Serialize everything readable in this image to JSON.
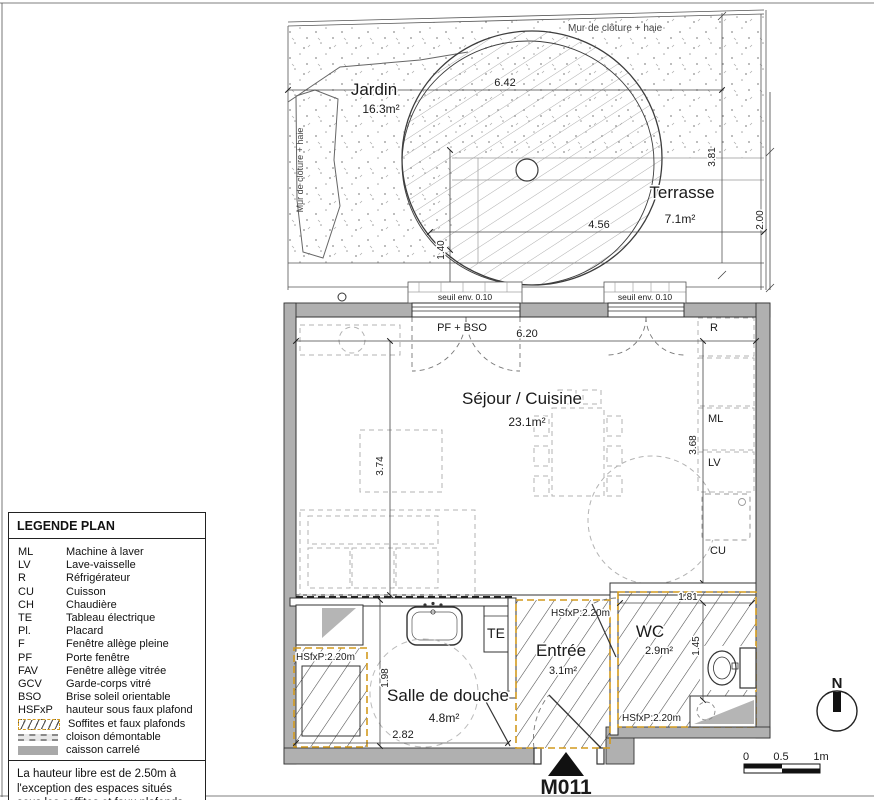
{
  "plan": {
    "labels": {
      "mur_top": "Mur de clôture + haie",
      "mur_left": "Mur de clôture + haie",
      "pf_bso": "PF + BSO",
      "seuil_left": "seuil env. 0.10",
      "seuil_right": "seuil env. 0.10",
      "te": "TE",
      "r": "R",
      "ml": "ML",
      "lv": "LV",
      "cu": "CU",
      "hsfxp_douche": "HSfxP:2.20m",
      "hsfxp_entree": "HSfxP:2.20m",
      "hsfxp_wc": "HSfxP:2.20m"
    },
    "rooms": {
      "jardin": {
        "name": "Jardin",
        "area": "16.3m²"
      },
      "terrasse": {
        "name": "Terrasse",
        "area": "7.1m²"
      },
      "sejour": {
        "name": "Séjour / Cuisine",
        "area": "23.1m²"
      },
      "douche": {
        "name": "Salle de douche",
        "area": "4.8m²"
      },
      "entree": {
        "name": "Entrée",
        "area": "3.1m²"
      },
      "wc": {
        "name": "WC",
        "area": "2.9m²"
      }
    },
    "dims": {
      "jardin_w": "6.42",
      "terrasse_w": "4.56",
      "terrasse_h": "3.81",
      "terrasse_d": "2.00",
      "step_w": "1.40",
      "sejour_w": "6.20",
      "sejour_hl": "3.74",
      "sejour_hr": "3.68",
      "douche_h": "1.98",
      "douche_w": "2.82",
      "wc_w": "1.81",
      "wc_h": "1.45"
    },
    "title": "M011",
    "north": "N",
    "scale": {
      "zero": "0",
      "half": "0.5",
      "one": "1m"
    }
  },
  "legend": {
    "title": "LEGENDE PLAN",
    "entries": [
      {
        "abbr": "ML",
        "label": "Machine à laver"
      },
      {
        "abbr": "LV",
        "label": "Lave-vaisselle"
      },
      {
        "abbr": "R",
        "label": "Réfrigérateur"
      },
      {
        "abbr": "CU",
        "label": "Cuisson"
      },
      {
        "abbr": "CH",
        "label": "Chaudière"
      },
      {
        "abbr": "TE",
        "label": "Tableau électrique"
      },
      {
        "abbr": "Pl.",
        "label": "Placard"
      },
      {
        "abbr": "F",
        "label": "Fenêtre allège pleine"
      },
      {
        "abbr": "PF",
        "label": "Porte fenêtre"
      },
      {
        "abbr": "FAV",
        "label": "Fenêtre allège vitrée"
      },
      {
        "abbr": "GCV",
        "label": "Garde-corps vitré"
      },
      {
        "abbr": "BSO",
        "label": "Brise soleil orientable"
      },
      {
        "abbr": "HSFxP",
        "label": "hauteur sous faux plafond"
      }
    ],
    "swatches": [
      {
        "label": "Soffites et faux plafonds"
      },
      {
        "label": "cloison démontable"
      },
      {
        "label": "caisson carrelé"
      }
    ],
    "note": "La hauteur libre est de 2.50m à l'exception des espaces situés sous les soffites et faux plafonds."
  },
  "colors": {
    "wall": "#b0b0b0",
    "soffite": "#d29a1e",
    "line": "#333333"
  }
}
